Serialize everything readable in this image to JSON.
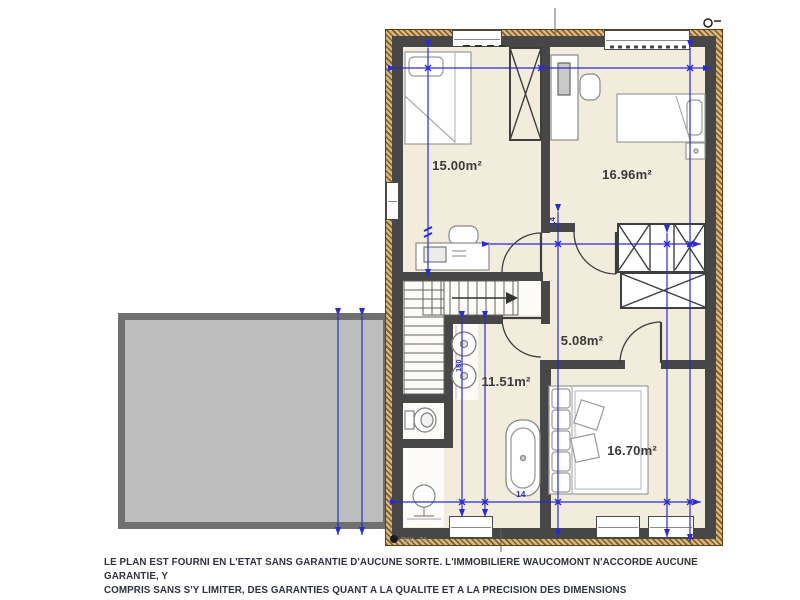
{
  "plan": {
    "rooms": [
      {
        "name": "bedroom-top-left",
        "area_label": "15.00m²"
      },
      {
        "name": "bedroom-top-right",
        "area_label": "16.96m²"
      },
      {
        "name": "hallway",
        "area_label": "5.08m²"
      },
      {
        "name": "bathroom",
        "area_label": "11.51m²"
      },
      {
        "name": "bedroom-bottom-right",
        "area_label": "16.70m²"
      }
    ],
    "dimension_marks": {
      "bottom_mark": "14",
      "hall_mark": "14",
      "sink_mark": "180"
    },
    "annotations": {
      "bottom_left_label": "RWA · T2"
    },
    "colors": {
      "floor": "#f2ecdd",
      "wall": "#474747",
      "dimension_blue": "#2a2ad6",
      "slab_fill": "#bdbdbd",
      "slab_border": "#6f6f6f",
      "hatch_light": "#d7b77e",
      "hatch_dark": "#7e5a28",
      "label_text": "#3a3a3a",
      "footer_text": "#2e323c"
    }
  },
  "footer": {
    "line1": "LE PLAN EST FOURNI EN L'ETAT SANS GARANTIE D'AUCUNE SORTE. L'IMMOBILIERE WAUCOMONT N'ACCORDE AUCUNE GARANTIE, Y",
    "line2": "COMPRIS SANS S'Y LIMITER, DES GARANTIES QUANT A LA QUALITE ET A LA PRECISION DES DIMENSIONS"
  }
}
